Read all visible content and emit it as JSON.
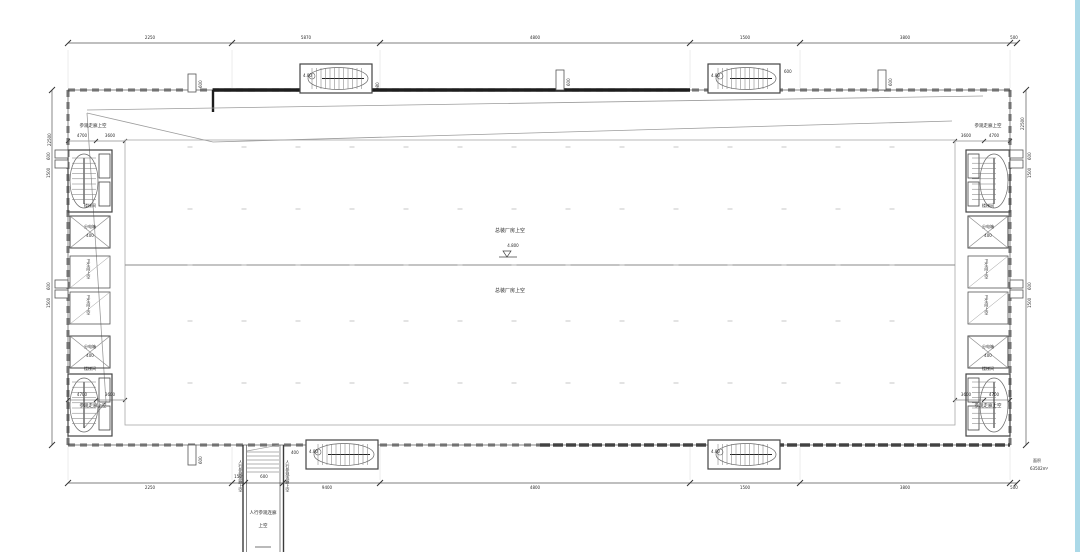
{
  "page": {
    "background": "#ffffff",
    "right_strip_color": "#abd9e8",
    "line_color": "#3c3c3c"
  },
  "hall": {
    "upper_label": "总装厂房上空",
    "lower_label": "总装厂房上空",
    "elevation": "4.800"
  },
  "walkway_label": "参观走廊上空",
  "corridor": {
    "line1": "人行参观连廊",
    "line2": "上空",
    "side_left": "人行参观连廊上空",
    "side_right": "人行参观连廊上空",
    "dim": "400"
  },
  "stairs": {
    "label": "楼梯间",
    "ext_elevation": "4.80",
    "ext_dim_left": "980",
    "ext_dim_right": "600"
  },
  "rooms": {
    "dist_label": "分电箱",
    "dist_dim": "400",
    "toilet_label": "卫生间上空"
  },
  "area_note": {
    "line1": "面积",
    "line2": "63502m²"
  },
  "dims": {
    "top": [
      "2250",
      "5870",
      "4800",
      "1500",
      "3800",
      "500"
    ],
    "bottom": [
      "2250",
      "150",
      "600",
      "9400",
      "4800",
      "1500",
      "3800",
      "500"
    ],
    "left_vertical": "22500",
    "right_vertical": "22500",
    "corner": {
      "a": "4700",
      "b": "3600"
    },
    "stub": "600",
    "stub_long": "1500"
  }
}
